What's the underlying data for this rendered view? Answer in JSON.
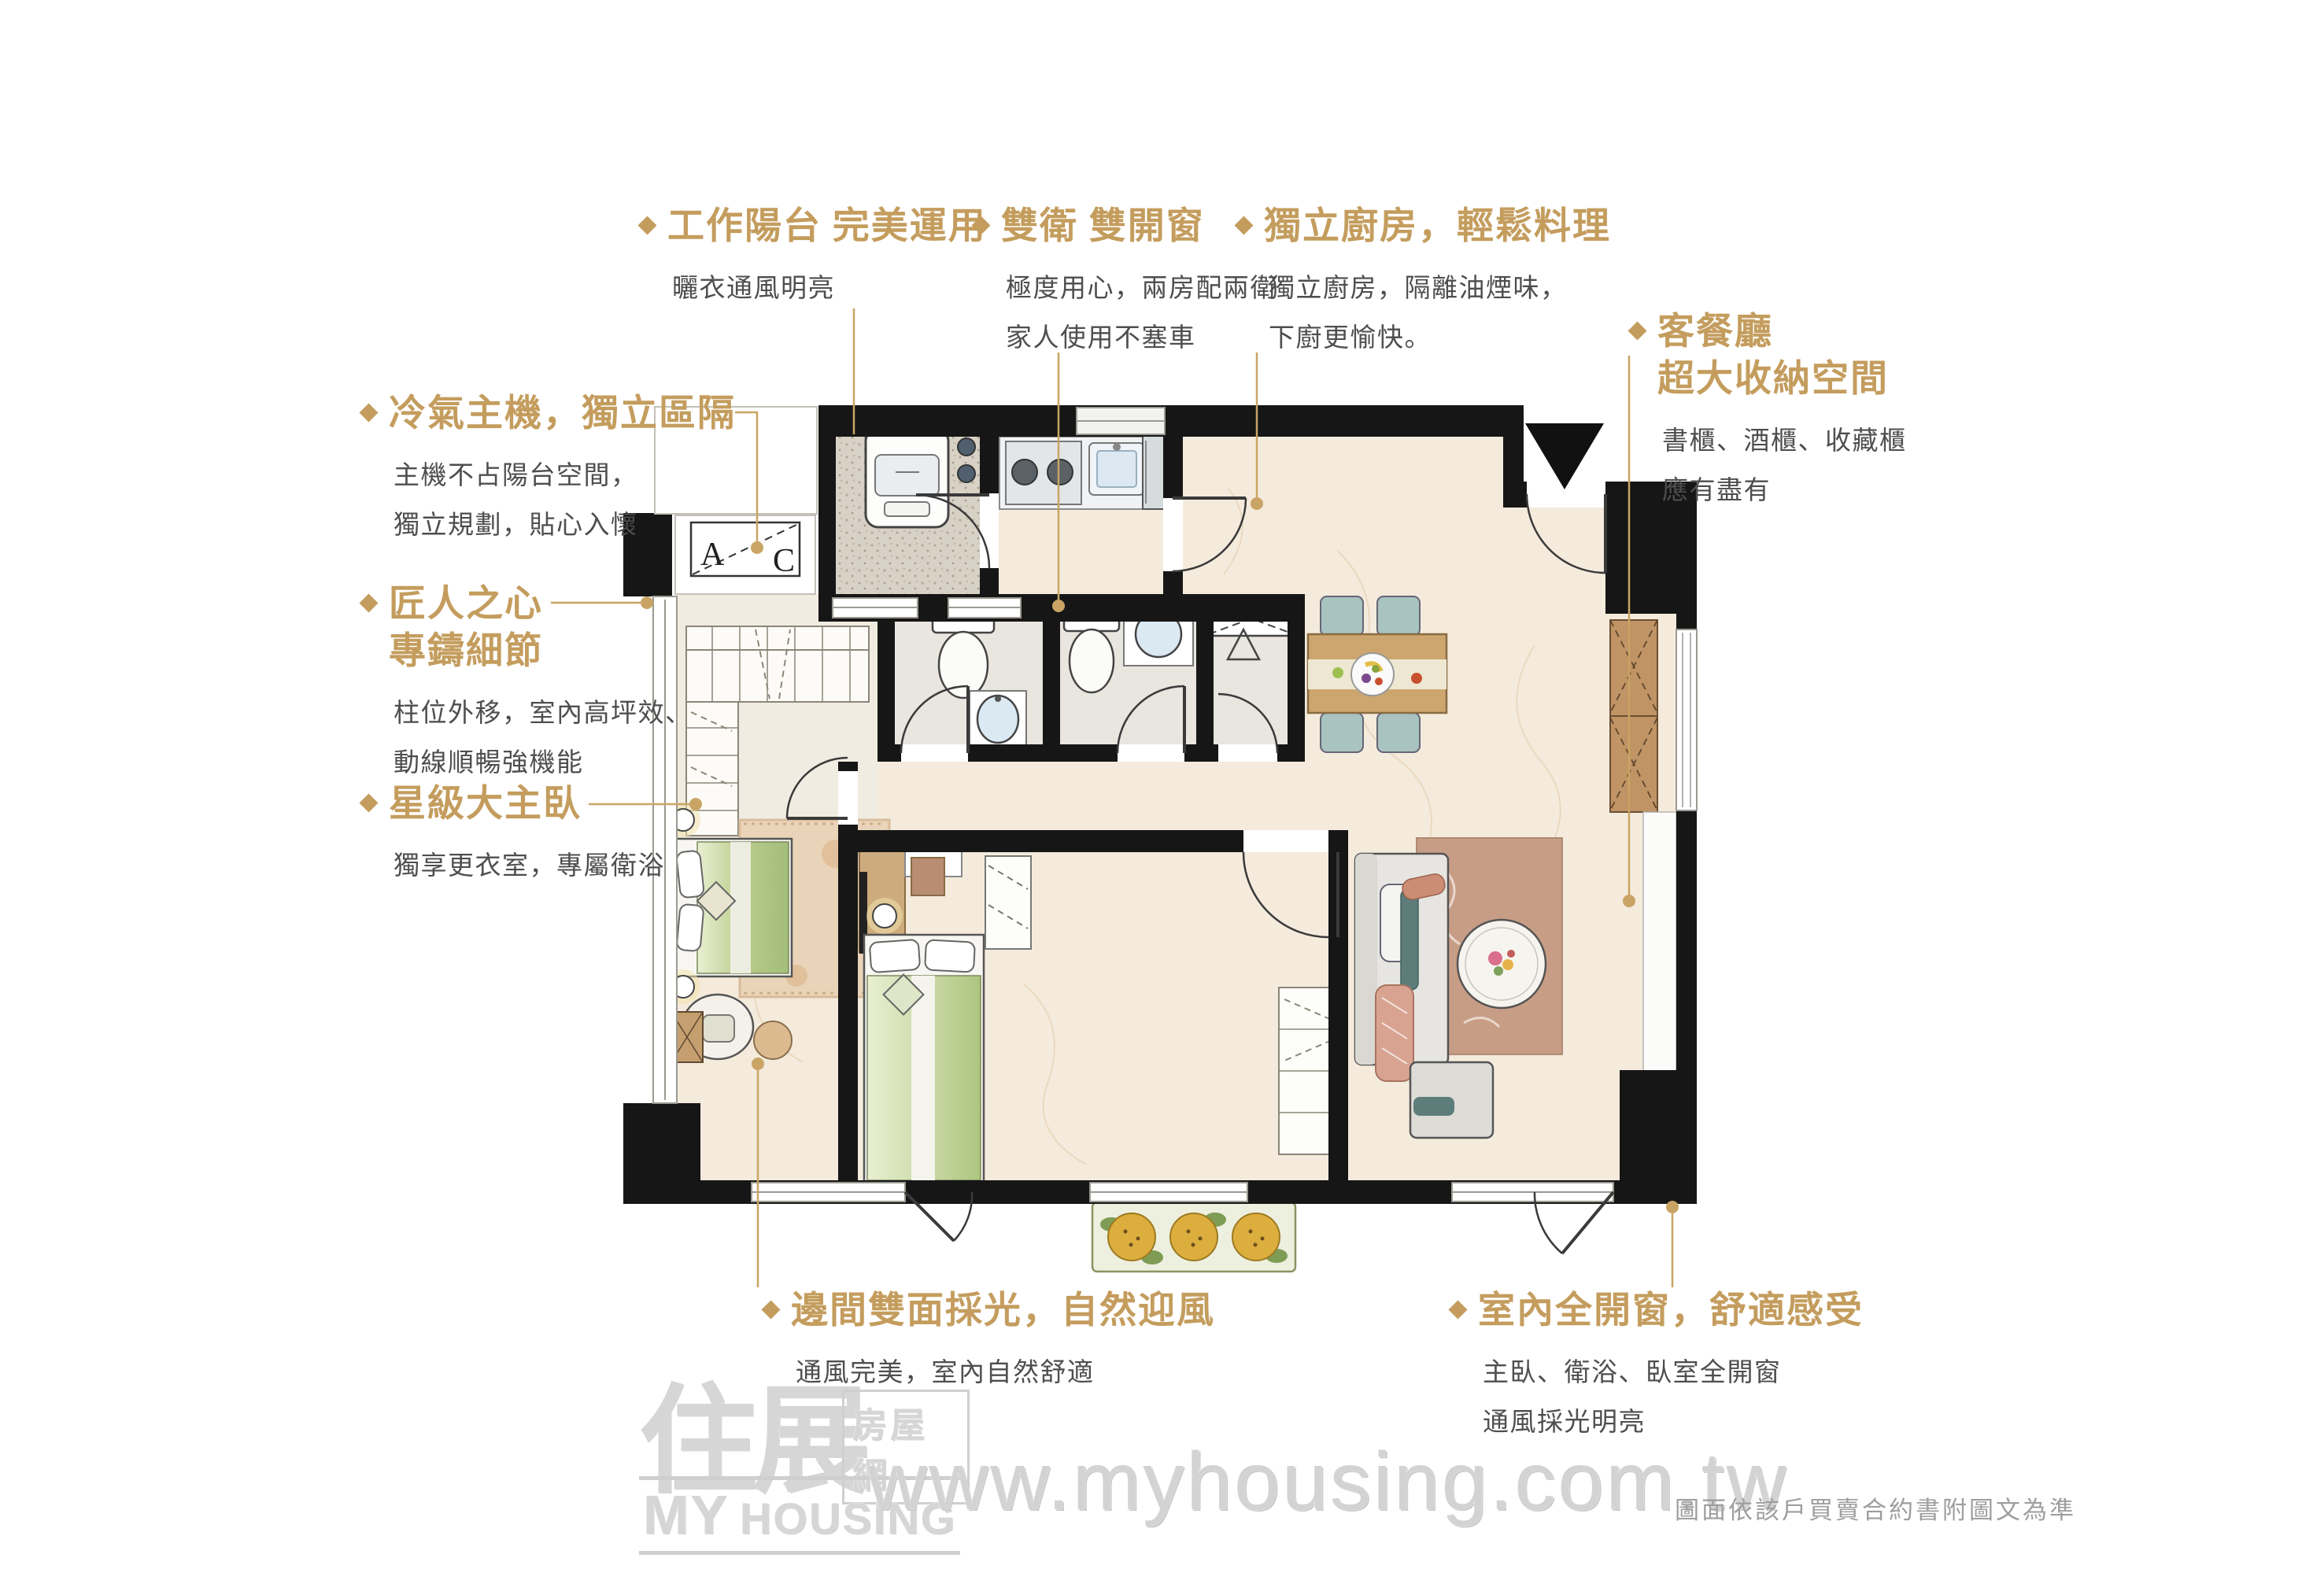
{
  "colors": {
    "accent_gold": "#C49D5E",
    "body_text": "#4E4E4E",
    "wall_black": "#161616",
    "floor_cream": "#F4EBDC",
    "watermark_gray": "#D3D3D3"
  },
  "callouts": {
    "work_balcony": {
      "title": "工作陽台 完美運用",
      "body": [
        "曬衣通風明亮"
      ]
    },
    "double_bath": {
      "title": "雙衛 雙開窗",
      "body": [
        "極度用心，兩房配兩衛",
        "家人使用不塞車"
      ]
    },
    "kitchen": {
      "title": "獨立廚房，輕鬆料理",
      "body": [
        "獨立廚房，隔離油煙味，",
        "下廚更愉快。"
      ]
    },
    "living_dining": {
      "title_lines": [
        "客餐廳",
        "超大收納空間"
      ],
      "body": [
        "書櫃、酒櫃、收藏櫃",
        "應有盡有"
      ]
    },
    "ac_unit": {
      "title": "冷氣主機，獨立區隔",
      "body": [
        "主機不占陽台空間，",
        "獨立規劃，貼心入懷"
      ]
    },
    "craftsman": {
      "title_lines": [
        "匠人之心",
        "專鑄細節"
      ],
      "body": [
        "柱位外移，室內高坪效、",
        "動線順暢強機能"
      ]
    },
    "master_bedroom": {
      "title": "星級大主臥",
      "body": [
        "獨享更衣室，專屬衛浴"
      ]
    },
    "corner_daylight": {
      "title": "邊間雙面採光，自然迎風",
      "body": [
        "通風完美，室內自然舒適"
      ]
    },
    "full_windows": {
      "title": "室內全開窗，舒適感受",
      "body": [
        "主臥、衛浴、臥室全開窗",
        "通風採光明亮"
      ]
    }
  },
  "plan": {
    "ac_unit": {
      "a": "A",
      "c": "C"
    }
  },
  "watermark": {
    "logo_zh_main": "住展",
    "logo_zh_sub": "房屋網",
    "logo_en_1": "MY",
    "logo_en_2": "HOUSING",
    "url": "www.myhousing.com.tw"
  },
  "footnote": "圖面依該戶買賣合約書附圖文為準"
}
